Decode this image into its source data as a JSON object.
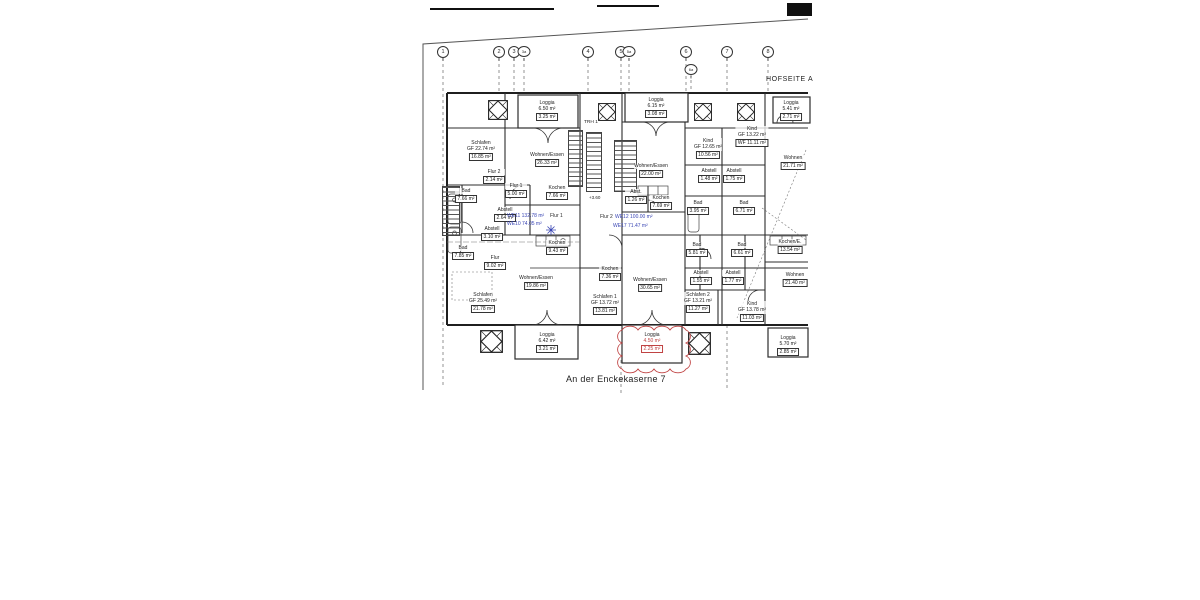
{
  "sheet": {
    "bottom_title": "An der Enckekaserne 7",
    "top_right_label": "HOFSEITE A",
    "trh_label": "TRH 1",
    "level_mark": "+3.60"
  },
  "colors": {
    "annotation_blue": "#3a46b4",
    "revision_red": "#c04343",
    "ink": "#2b2b2b"
  },
  "grid_axes": [
    {
      "label": "1",
      "x": 443
    },
    {
      "label": "2",
      "x": 499
    },
    {
      "label": "3",
      "x": 514
    },
    {
      "label": "3a",
      "x": 524,
      "small": true
    },
    {
      "label": "4",
      "x": 588
    },
    {
      "label": "5",
      "x": 621
    },
    {
      "label": "5a",
      "x": 629,
      "small": true
    },
    {
      "label": "6",
      "x": 686
    },
    {
      "label": "6a",
      "x": 691,
      "y": 64,
      "small": true
    },
    {
      "label": "7",
      "x": 727
    },
    {
      "label": "8",
      "x": 768
    }
  ],
  "rooms": [
    {
      "x": 547,
      "y": 100,
      "lines": [
        "Loggia",
        "6.50 m²"
      ],
      "boxed": "3.25 m²"
    },
    {
      "x": 656,
      "y": 97,
      "lines": [
        "Loggia",
        "6.15 m²"
      ],
      "boxed": "3.08 m²"
    },
    {
      "x": 791,
      "y": 100,
      "lines": [
        "Loggia",
        "5.41 m²"
      ],
      "boxed": "2.71 m²"
    },
    {
      "x": 481,
      "y": 140,
      "lines": [
        "Schlafen",
        "GF 22.74 m²"
      ],
      "boxed": "16.85 m²"
    },
    {
      "x": 547,
      "y": 152,
      "lines": [
        "Wohnen/Essen"
      ],
      "boxed": "26.33 m²"
    },
    {
      "x": 651,
      "y": 163,
      "lines": [
        "Wohnen/Essen"
      ],
      "boxed": "22.00 m²"
    },
    {
      "x": 708,
      "y": 138,
      "lines": [
        "Kind",
        "GF 12.65 m²"
      ],
      "boxed": "10.56 m²"
    },
    {
      "x": 752,
      "y": 126,
      "lines": [
        "Kind",
        "GF 13.22 m²"
      ],
      "boxed": "WF 11.11 m²"
    },
    {
      "x": 793,
      "y": 155,
      "lines": [
        "Wohnen"
      ],
      "boxed": "21.71 m²"
    },
    {
      "x": 494,
      "y": 169,
      "lines": [
        "Flur 2"
      ],
      "boxed": "2.14 m²"
    },
    {
      "x": 466,
      "y": 188,
      "lines": [
        "Bad"
      ],
      "boxed": "7.66 m²"
    },
    {
      "x": 516,
      "y": 183,
      "lines": [
        "Flur 1"
      ],
      "boxed": "5.00 m²"
    },
    {
      "x": 557,
      "y": 185,
      "lines": [
        "Kochen"
      ],
      "boxed": "7.66 m²"
    },
    {
      "x": 636,
      "y": 189,
      "lines": [
        "Abst."
      ],
      "boxed": "1.26 m²"
    },
    {
      "x": 661,
      "y": 195,
      "lines": [
        "Kochen"
      ],
      "boxed": "7.69 m²"
    },
    {
      "x": 709,
      "y": 168,
      "lines": [
        "Abstell"
      ],
      "boxed": "1.48 m²"
    },
    {
      "x": 734,
      "y": 168,
      "lines": [
        "Abstell"
      ],
      "boxed": "1.75 m²"
    },
    {
      "x": 698,
      "y": 200,
      "lines": [
        "Bad"
      ],
      "boxed": "3.95 m²"
    },
    {
      "x": 744,
      "y": 200,
      "lines": [
        "Bad"
      ],
      "boxed": "6.71 m²"
    },
    {
      "x": 505,
      "y": 207,
      "lines": [
        "Abstell"
      ],
      "boxed": "2.64 m²"
    },
    {
      "x": 492,
      "y": 226,
      "lines": [
        "Abstell"
      ],
      "boxed": "3.10 m²"
    },
    {
      "x": 463,
      "y": 245,
      "lines": [
        "Bad"
      ],
      "boxed": "7.85 m²"
    },
    {
      "x": 495,
      "y": 255,
      "lines": [
        "Flur"
      ],
      "boxed": "9.02 m²"
    },
    {
      "x": 557,
      "y": 240,
      "lines": [
        "Kochen"
      ],
      "boxed": "9.43 m²"
    },
    {
      "x": 610,
      "y": 266,
      "lines": [
        "Kochen"
      ],
      "boxed": "7.36 m²"
    },
    {
      "x": 536,
      "y": 275,
      "lines": [
        "Wohnen/Essen"
      ],
      "boxed": "19.86 m²"
    },
    {
      "x": 650,
      "y": 277,
      "lines": [
        "Wohnen/Essen"
      ],
      "boxed": "30.65 m²"
    },
    {
      "x": 483,
      "y": 292,
      "lines": [
        "Schlafen",
        "GF 25.49 m²"
      ],
      "boxed": "21.78 m²"
    },
    {
      "x": 605,
      "y": 294,
      "lines": [
        "Schlafen 1",
        "GF 13.72 m²"
      ],
      "boxed": "13.81 m²"
    },
    {
      "x": 698,
      "y": 292,
      "lines": [
        "Schlafen 2",
        "GF 13.21 m²"
      ],
      "boxed": "11.27 m²"
    },
    {
      "x": 697,
      "y": 242,
      "lines": [
        "Bad"
      ],
      "boxed": "5.81 m²"
    },
    {
      "x": 742,
      "y": 242,
      "lines": [
        "Bad"
      ],
      "boxed": "6.61 m²"
    },
    {
      "x": 701,
      "y": 270,
      "lines": [
        "Abstell"
      ],
      "boxed": "1.55 m²"
    },
    {
      "x": 733,
      "y": 270,
      "lines": [
        "Abstell"
      ],
      "boxed": "1.77 m²"
    },
    {
      "x": 790,
      "y": 239,
      "lines": [
        "Kochen/E."
      ],
      "boxed": "13.54 m²"
    },
    {
      "x": 795,
      "y": 272,
      "lines": [
        "Wohnen"
      ],
      "boxed": "21.40 m²"
    },
    {
      "x": 752,
      "y": 301,
      "lines": [
        "Kind",
        "GF 13.78 m²"
      ],
      "boxed": "11.03 m²"
    },
    {
      "x": 547,
      "y": 332,
      "lines": [
        "Loggia",
        "6.42 m²"
      ],
      "boxed": "3.21 m²"
    },
    {
      "x": 652,
      "y": 332,
      "lines": [
        "Loggia",
        "4.50 m²"
      ],
      "boxed": "2.25 m²",
      "color": "red"
    },
    {
      "x": 788,
      "y": 335,
      "lines": [
        "Loggia",
        "5.70 m²"
      ],
      "boxed": "2.85 m²"
    }
  ],
  "we_annotations": [
    {
      "text": "WE11 132.78 m²",
      "x": 507,
      "y": 214,
      "color": "blue"
    },
    {
      "text": "Flur 1",
      "x": 550,
      "y": 214,
      "color": "black"
    },
    {
      "text": "WE10 74.05 m²",
      "x": 507,
      "y": 222,
      "color": "blue"
    },
    {
      "text": "Flur 2",
      "x": 600,
      "y": 215,
      "color": "black"
    },
    {
      "text": "WE12 100.00 m²",
      "x": 615,
      "y": 215,
      "color": "blue"
    },
    {
      "text": "WE17 71.47 m²",
      "x": 613,
      "y": 224,
      "color": "blue"
    }
  ]
}
